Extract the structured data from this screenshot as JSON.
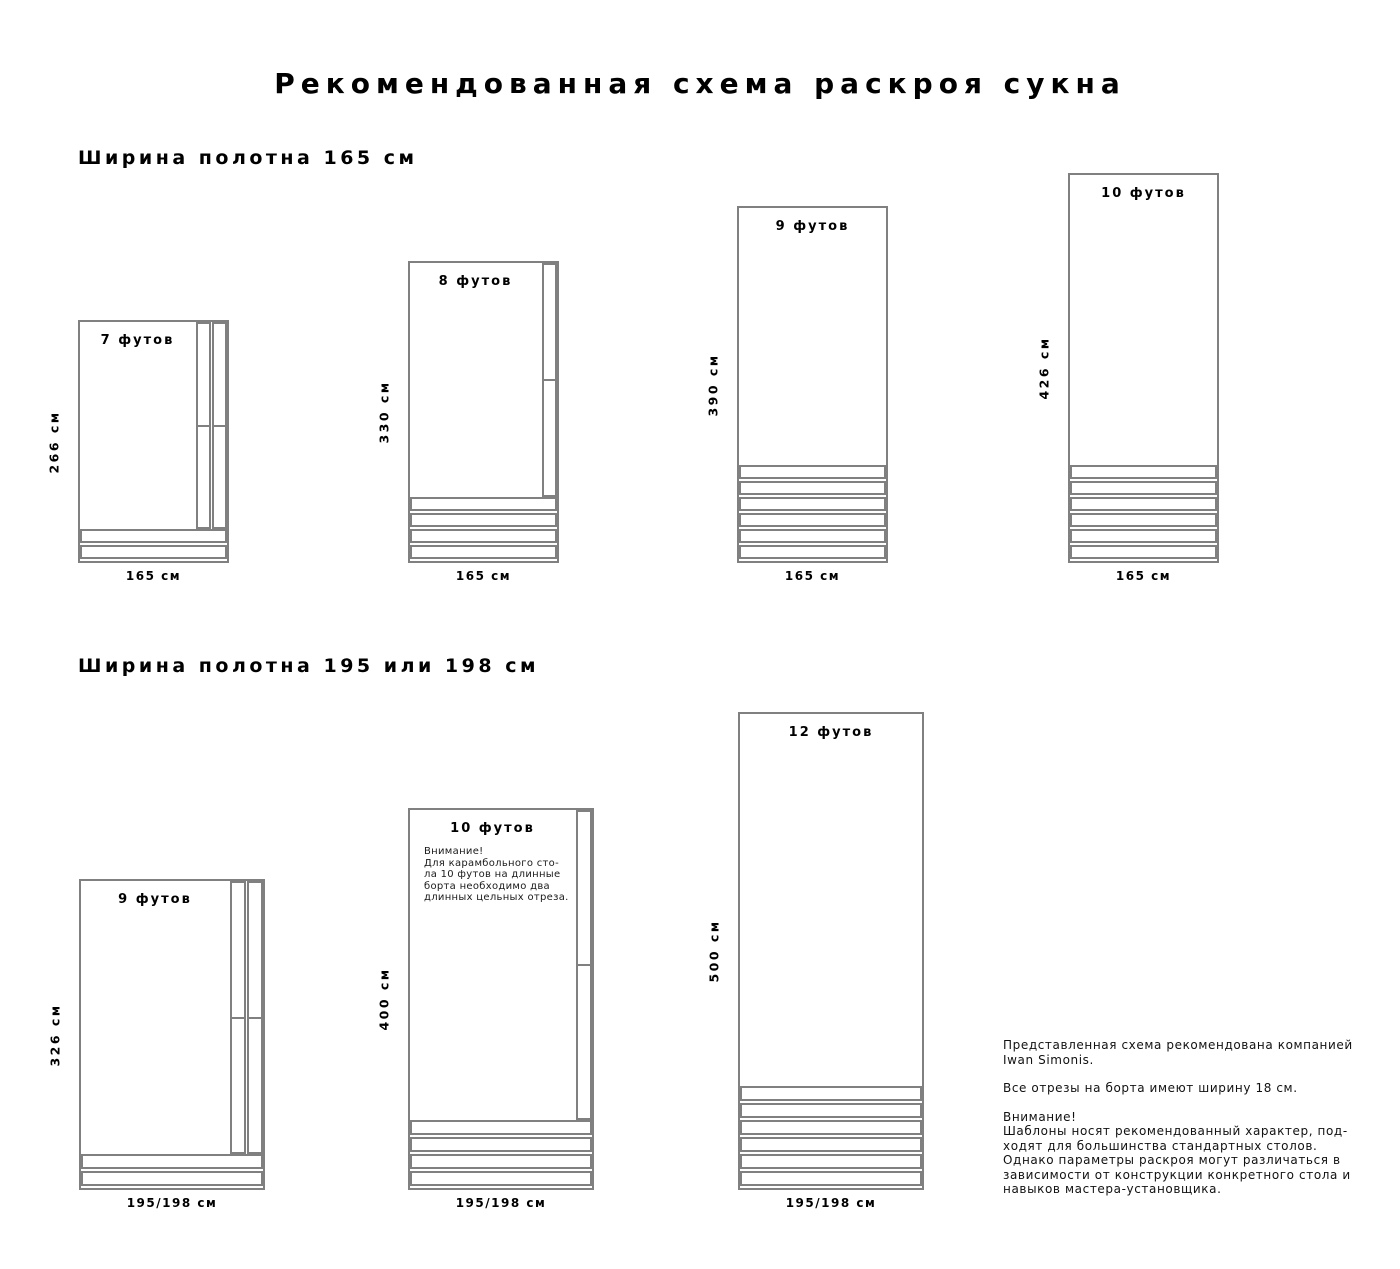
{
  "page": {
    "title": "Рекомендованная схема раскроя сукна"
  },
  "rail_strip_width_cm": 18,
  "colors": {
    "line": "#808080",
    "text": "#000000"
  },
  "sections": [
    {
      "heading": "Ширина полотна 165 см",
      "cloth_width_cm": 165,
      "diagrams": [
        {
          "id": "7ft",
          "size_label": "7 футов",
          "height_label": "266 см",
          "width_label": "165 см",
          "height_cm": 266,
          "width_cm": 165,
          "vertical_strips": 2,
          "bottom_strips": 2
        },
        {
          "id": "8ft",
          "size_label": "8 футов",
          "height_label": "330 см",
          "width_label": "165 см",
          "height_cm": 330,
          "width_cm": 165,
          "vertical_strips": 1,
          "bottom_strips": 4
        },
        {
          "id": "9ft",
          "size_label": "9 футов",
          "height_label": "390 см",
          "width_label": "165 см",
          "height_cm": 390,
          "width_cm": 165,
          "vertical_strips": 0,
          "bottom_strips": 6
        },
        {
          "id": "10ft",
          "size_label": "10 футов",
          "height_label": "426 см",
          "width_label": "165 см",
          "height_cm": 426,
          "width_cm": 165,
          "vertical_strips": 0,
          "bottom_strips": 6
        }
      ]
    },
    {
      "heading": "Ширина полотна 195 или 198 см",
      "cloth_width_cm": 195,
      "diagrams": [
        {
          "id": "9ft-wide",
          "size_label": "9 футов",
          "height_label": "326 см",
          "width_label": "195/198 см",
          "height_cm": 326,
          "width_cm": 195,
          "vertical_strips": 2,
          "bottom_strips": 2
        },
        {
          "id": "10ft-wide",
          "size_label": "10 футов",
          "height_label": "400 см",
          "width_label": "195/198 см",
          "height_cm": 400,
          "width_cm": 195,
          "vertical_strips": 1,
          "bottom_strips": 4,
          "note": "Внимание!\nДля карамбольного сто-\nла 10 футов на длинные\nборта необходимо два\nдлинных цельных отреза."
        },
        {
          "id": "12ft-wide",
          "size_label": "12 футов",
          "height_label": "500 см",
          "width_label": "195/198 см",
          "height_cm": 500,
          "width_cm": 195,
          "vertical_strips": 0,
          "bottom_strips": 6
        }
      ]
    }
  ],
  "footer": {
    "paragraphs": [
      "Представленная схема рекомендована компанией\nIwan Simonis.",
      "Все отрезы на борта имеют ширину 18 см.",
      "Внимание!\nШаблоны носят рекомендованный характер, под-\nходят для большинства стандартных столов.\nОднако параметры раскроя могут различаться в\nзависимости от конструкции конкретного стола и\nнавыков мастера-установщика."
    ]
  }
}
